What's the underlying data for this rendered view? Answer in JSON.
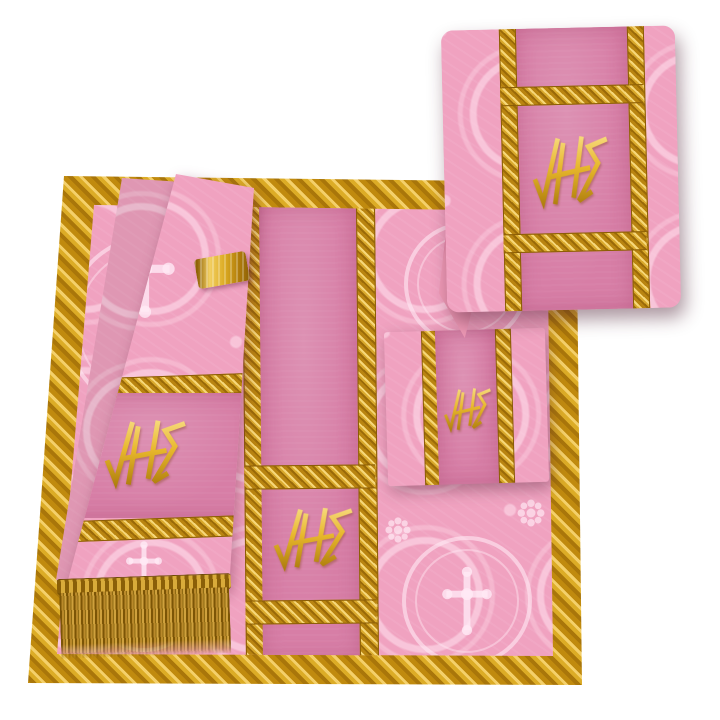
{
  "page": {
    "background": "#ffffff",
    "description": "Product photo of a rose-pink Gothic Mass vestment set with golden braided trims, bullion fringe and embroidered JHS monograms"
  },
  "monogram": {
    "text": "JHS"
  },
  "items": {
    "chasuble": {
      "label": "Folded chasuble panel with central orphrey band"
    },
    "maniple": {
      "label": "Maniple with JHS embroidery and golden fringe"
    },
    "burse": {
      "label": "Burse with JHS embroidery"
    },
    "veil": {
      "label": "Chalice veil draped, with JHS embroidery"
    }
  },
  "colors": {
    "bg": "#ffffff",
    "damask_pink": "#f0a2c0",
    "damask_pattern": "#fbd3e2",
    "panel_pink": "#d77ea6",
    "gold": "#d89c14",
    "gold_light": "#f4d06a",
    "gold_dark": "#9a6a08",
    "fringe_gold": "#b9892a",
    "embroidery_gold": "#e7b72b",
    "lining_pink": "#ee9ab6",
    "fold_edge": "#d4688f"
  }
}
